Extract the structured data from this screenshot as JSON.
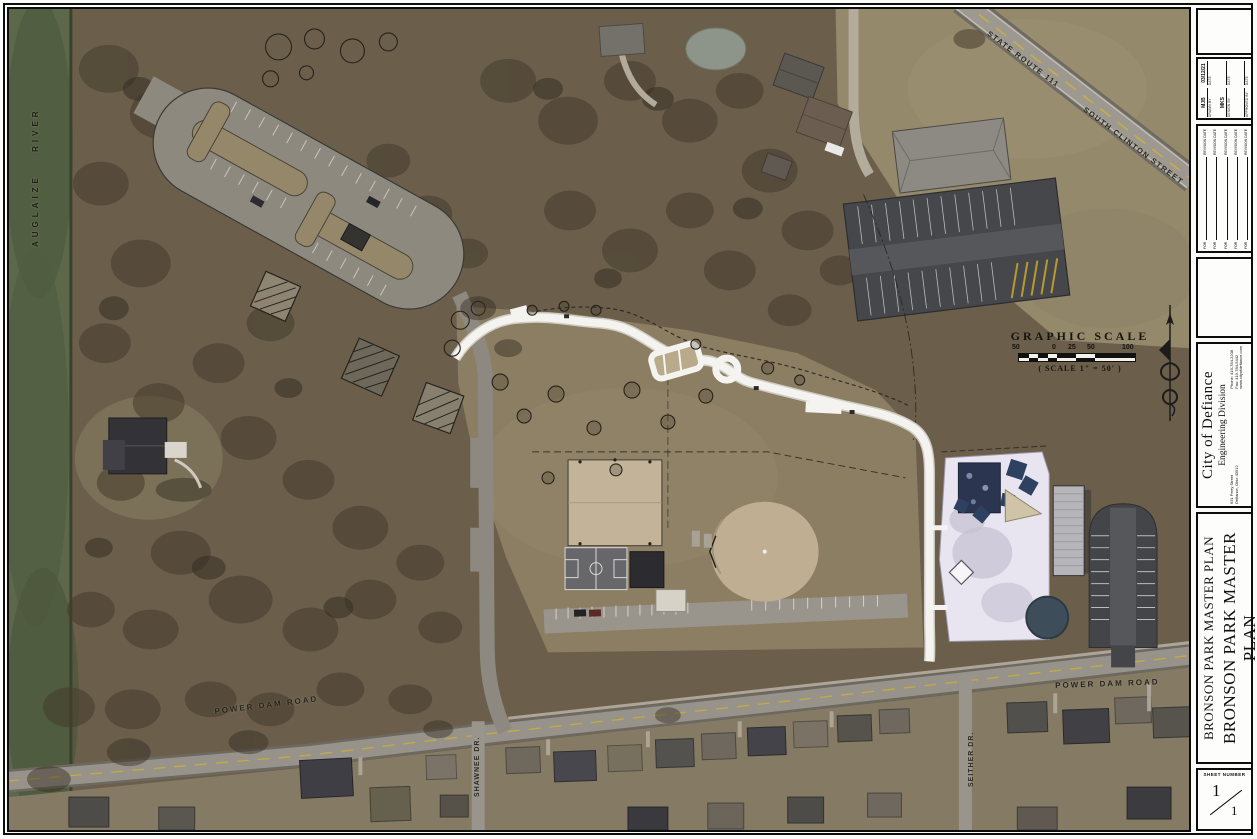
{
  "map": {
    "labels": {
      "river": "AUGLAIZE RIVER",
      "state_route": "STATE ROUTE 111",
      "south_clinton": "SOUTH CLINTON STREET",
      "power_dam_west": "POWER DAM ROAD",
      "power_dam_east": "POWER DAM ROAD",
      "shawnee": "SHAWNEE DR.",
      "seither": "SEITHER DR."
    },
    "scale": {
      "title": "GRAPHIC SCALE",
      "ticks": [
        "50",
        "0",
        "25",
        "50",
        "100"
      ],
      "note": "( SCALE 1\" = 50' )"
    }
  },
  "titleblock": {
    "credits": {
      "drawn_by": "MJB",
      "drawn_by_label": "DRAWN BY",
      "drawn_date": "03/12/21",
      "design_by": "MKS",
      "design_by_label": "DESIGN BY",
      "approved_by": "",
      "approved_by_label": "APPROVED BY",
      "date_label": "DATE"
    },
    "revisions": {
      "for_label": "FOR",
      "date_label": "REVISION DATE"
    },
    "agency": {
      "name": "City of Defiance",
      "division": "Engineering Division",
      "address_line1": "631 Perry Street",
      "address_line2": "Defiance, Ohio 43512",
      "phone_label": "Phone:",
      "phone": "419-784-2208",
      "fax_label": "Fax:",
      "fax": "419-784-5442",
      "website": "www.cityofdefiance.com"
    },
    "project_title": "BRONSON PARK MASTER PLAN",
    "sheet_title": "BRONSON PARK MASTER PLAN",
    "sheet_number_label": "SHEET NUMBER",
    "sheet_number_numerator": "1",
    "sheet_number_denominator": "1"
  }
}
